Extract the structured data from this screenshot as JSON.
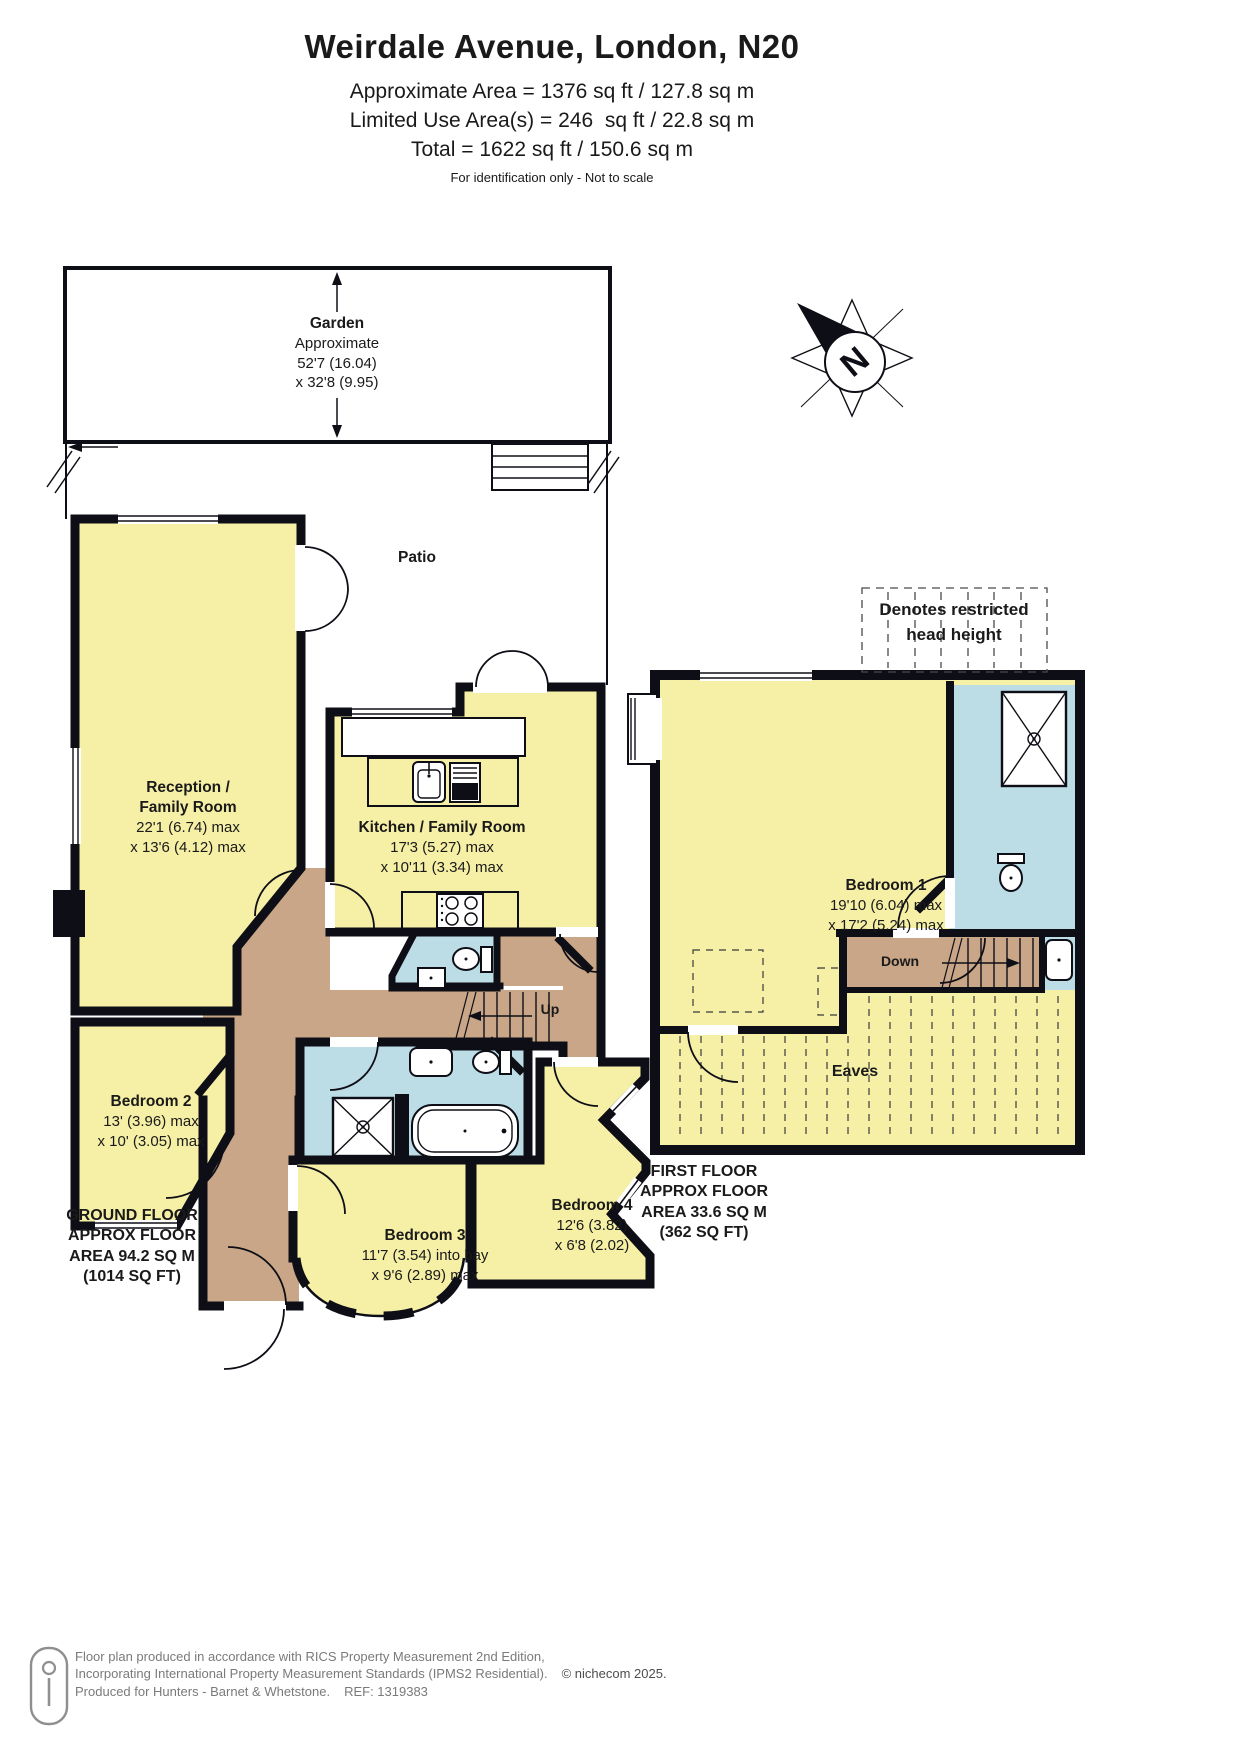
{
  "header": {
    "title": "Weirdale Avenue, London, N20",
    "area_line1": "Approximate Area = 1376 sq ft / 127.8 sq m",
    "area_line2": "Limited Use Area(s) = 246  sq ft / 22.8 sq m",
    "area_line3": "Total = 1622 sq ft / 150.6 sq m",
    "disclaimer": "For identification only - Not to scale"
  },
  "compass": {
    "label": "N"
  },
  "legend": {
    "line1": "Denotes restricted",
    "line2": "head height"
  },
  "garden": {
    "name": "Garden",
    "line1": "Approximate",
    "line2": "52'7 (16.04)",
    "line3": "x 32'8 (9.95)"
  },
  "ground_floor": {
    "patio_label": "Patio",
    "stairs_label": "Up",
    "reception": {
      "l1": "Reception /",
      "l2": "Family Room",
      "l3": "22'1 (6.74) max",
      "l4": "x 13'6 (4.12) max"
    },
    "kitchen": {
      "l1": "Kitchen / Family Room",
      "l2": "17'3 (5.27) max",
      "l3": "x 10'11 (3.34) max"
    },
    "bedroom2": {
      "l1": "Bedroom 2",
      "l2": "13' (3.96) max",
      "l3": "x 10' (3.05) max"
    },
    "bedroom3": {
      "l1": "Bedroom 3",
      "l2": "11'7 (3.54) into bay",
      "l3": "x 9'6 (2.89) max"
    },
    "bedroom4": {
      "l1": "Bedroom 4",
      "l2": "12'6 (3.82)",
      "l3": "x 6'8 (2.02)"
    },
    "floor_label": {
      "l1": "GROUND FLOOR",
      "l2": "APPROX FLOOR",
      "l3": "AREA 94.2 SQ M",
      "l4": "(1014 SQ FT)"
    }
  },
  "first_floor": {
    "stairs_label": "Down",
    "eaves_label": "Eaves",
    "bedroom1": {
      "l1": "Bedroom 1",
      "l2": "19'10 (6.04) max",
      "l3": "x 17'2 (5.24) max"
    },
    "floor_label": {
      "l1": "FIRST FLOOR",
      "l2": "APPROX FLOOR",
      "l3": "AREA 33.6 SQ M",
      "l4": "(362 SQ FT)"
    }
  },
  "footer": {
    "line1": "Floor plan produced in accordance with RICS Property Measurement 2nd Edition,",
    "line2": "Incorporating International Property Measurement Standards (IPMS2 Residential).",
    "copyright": "© nichecom 2025.",
    "line3": "Produced for Hunters - Barnet & Whetstone.",
    "ref": "REF: 1319383"
  },
  "colors": {
    "room_yellow": "#f6f0a6",
    "wet_blue": "#bcdce6",
    "hall_tan": "#c8a687",
    "wall": "#0e0e16"
  }
}
